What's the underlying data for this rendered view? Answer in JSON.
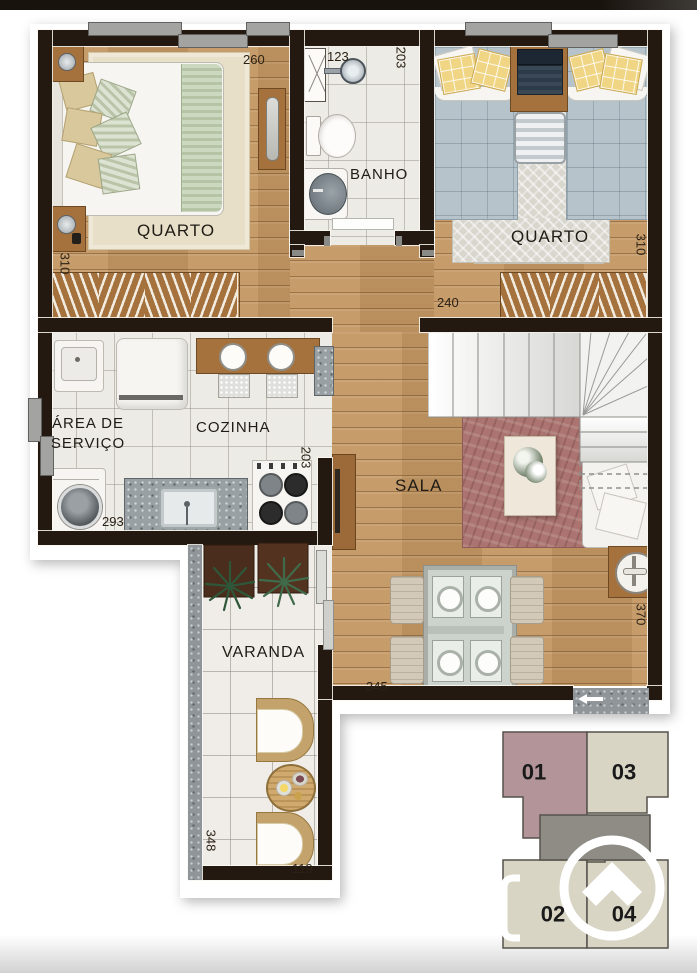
{
  "page": {
    "type": "apartment-floor-plan"
  },
  "rooms": {
    "quarto1": "QUARTO",
    "banho": "BANHO",
    "quarto2": "QUARTO",
    "area_servico_1": "ÁREA DE",
    "area_servico_2": "SERVIÇO",
    "cozinha": "COZINHA",
    "sala": "SALA",
    "varanda": "VARANDA"
  },
  "dims": {
    "d260": "260",
    "d123": "123",
    "d203_banho": "203",
    "d310_q1": "310",
    "d310_q2": "310",
    "d240": "240",
    "d203_coz": "203",
    "d293": "293",
    "d345": "345",
    "d370": "370",
    "d348": "348",
    "d119": "119"
  },
  "key_plan": {
    "units": [
      {
        "number": "01",
        "highlighted": true
      },
      {
        "number": "03",
        "highlighted": false
      },
      {
        "number": "02",
        "highlighted": false
      },
      {
        "number": "04",
        "highlighted": false
      }
    ],
    "highlight_color": "#b39599",
    "unit_color": "#d8d5c5",
    "core_color": "#8f8c85",
    "logo_icon": "home-arrow-icon"
  },
  "colors": {
    "wall": "#241911",
    "wood_floor": "#c49763",
    "tile_floor": "#edebe6",
    "granite": "#99a0a3",
    "sala_rug": "#ab7470",
    "top_band": "#19130e"
  },
  "icons": {
    "entry_arrow": "left-arrow-icon"
  }
}
